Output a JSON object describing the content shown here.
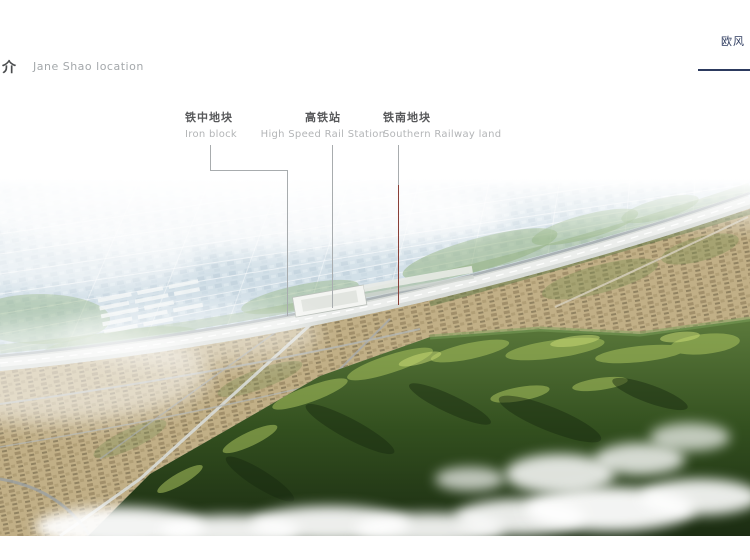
{
  "header": {
    "title_zh": "简介",
    "subtitle_en": "Jane Shao location"
  },
  "logo": {
    "line1_zh": "欧风",
    "line2_en": "Landsc",
    "color": "#2c3a5e"
  },
  "annotations": [
    {
      "label_zh": "铁中地块",
      "label_en": "Iron block"
    },
    {
      "label_zh": "高铁站",
      "label_en": "High Speed Rail Station"
    },
    {
      "label_zh": "铁南地块",
      "label_en": "Southern Railway land"
    }
  ],
  "leader_lines": {
    "gray": "#a8acae",
    "red": "#8a4038"
  },
  "colors": {
    "label_zh_text": "#58595b",
    "label_en_text": "#b3b5b7",
    "header_title": "#4a4c4e",
    "header_subtitle": "#a4a8ab",
    "logo_navy": "#2c3a5e",
    "city_haze_blue": "#ccdbe5",
    "corridor_gray": "#d6dad6",
    "buildings_tan": "#c0ad83",
    "mountain_dark_green": "#1b2c12",
    "mountain_sunlit_green": "#aac35e",
    "cloud_white": "#ffffff"
  }
}
